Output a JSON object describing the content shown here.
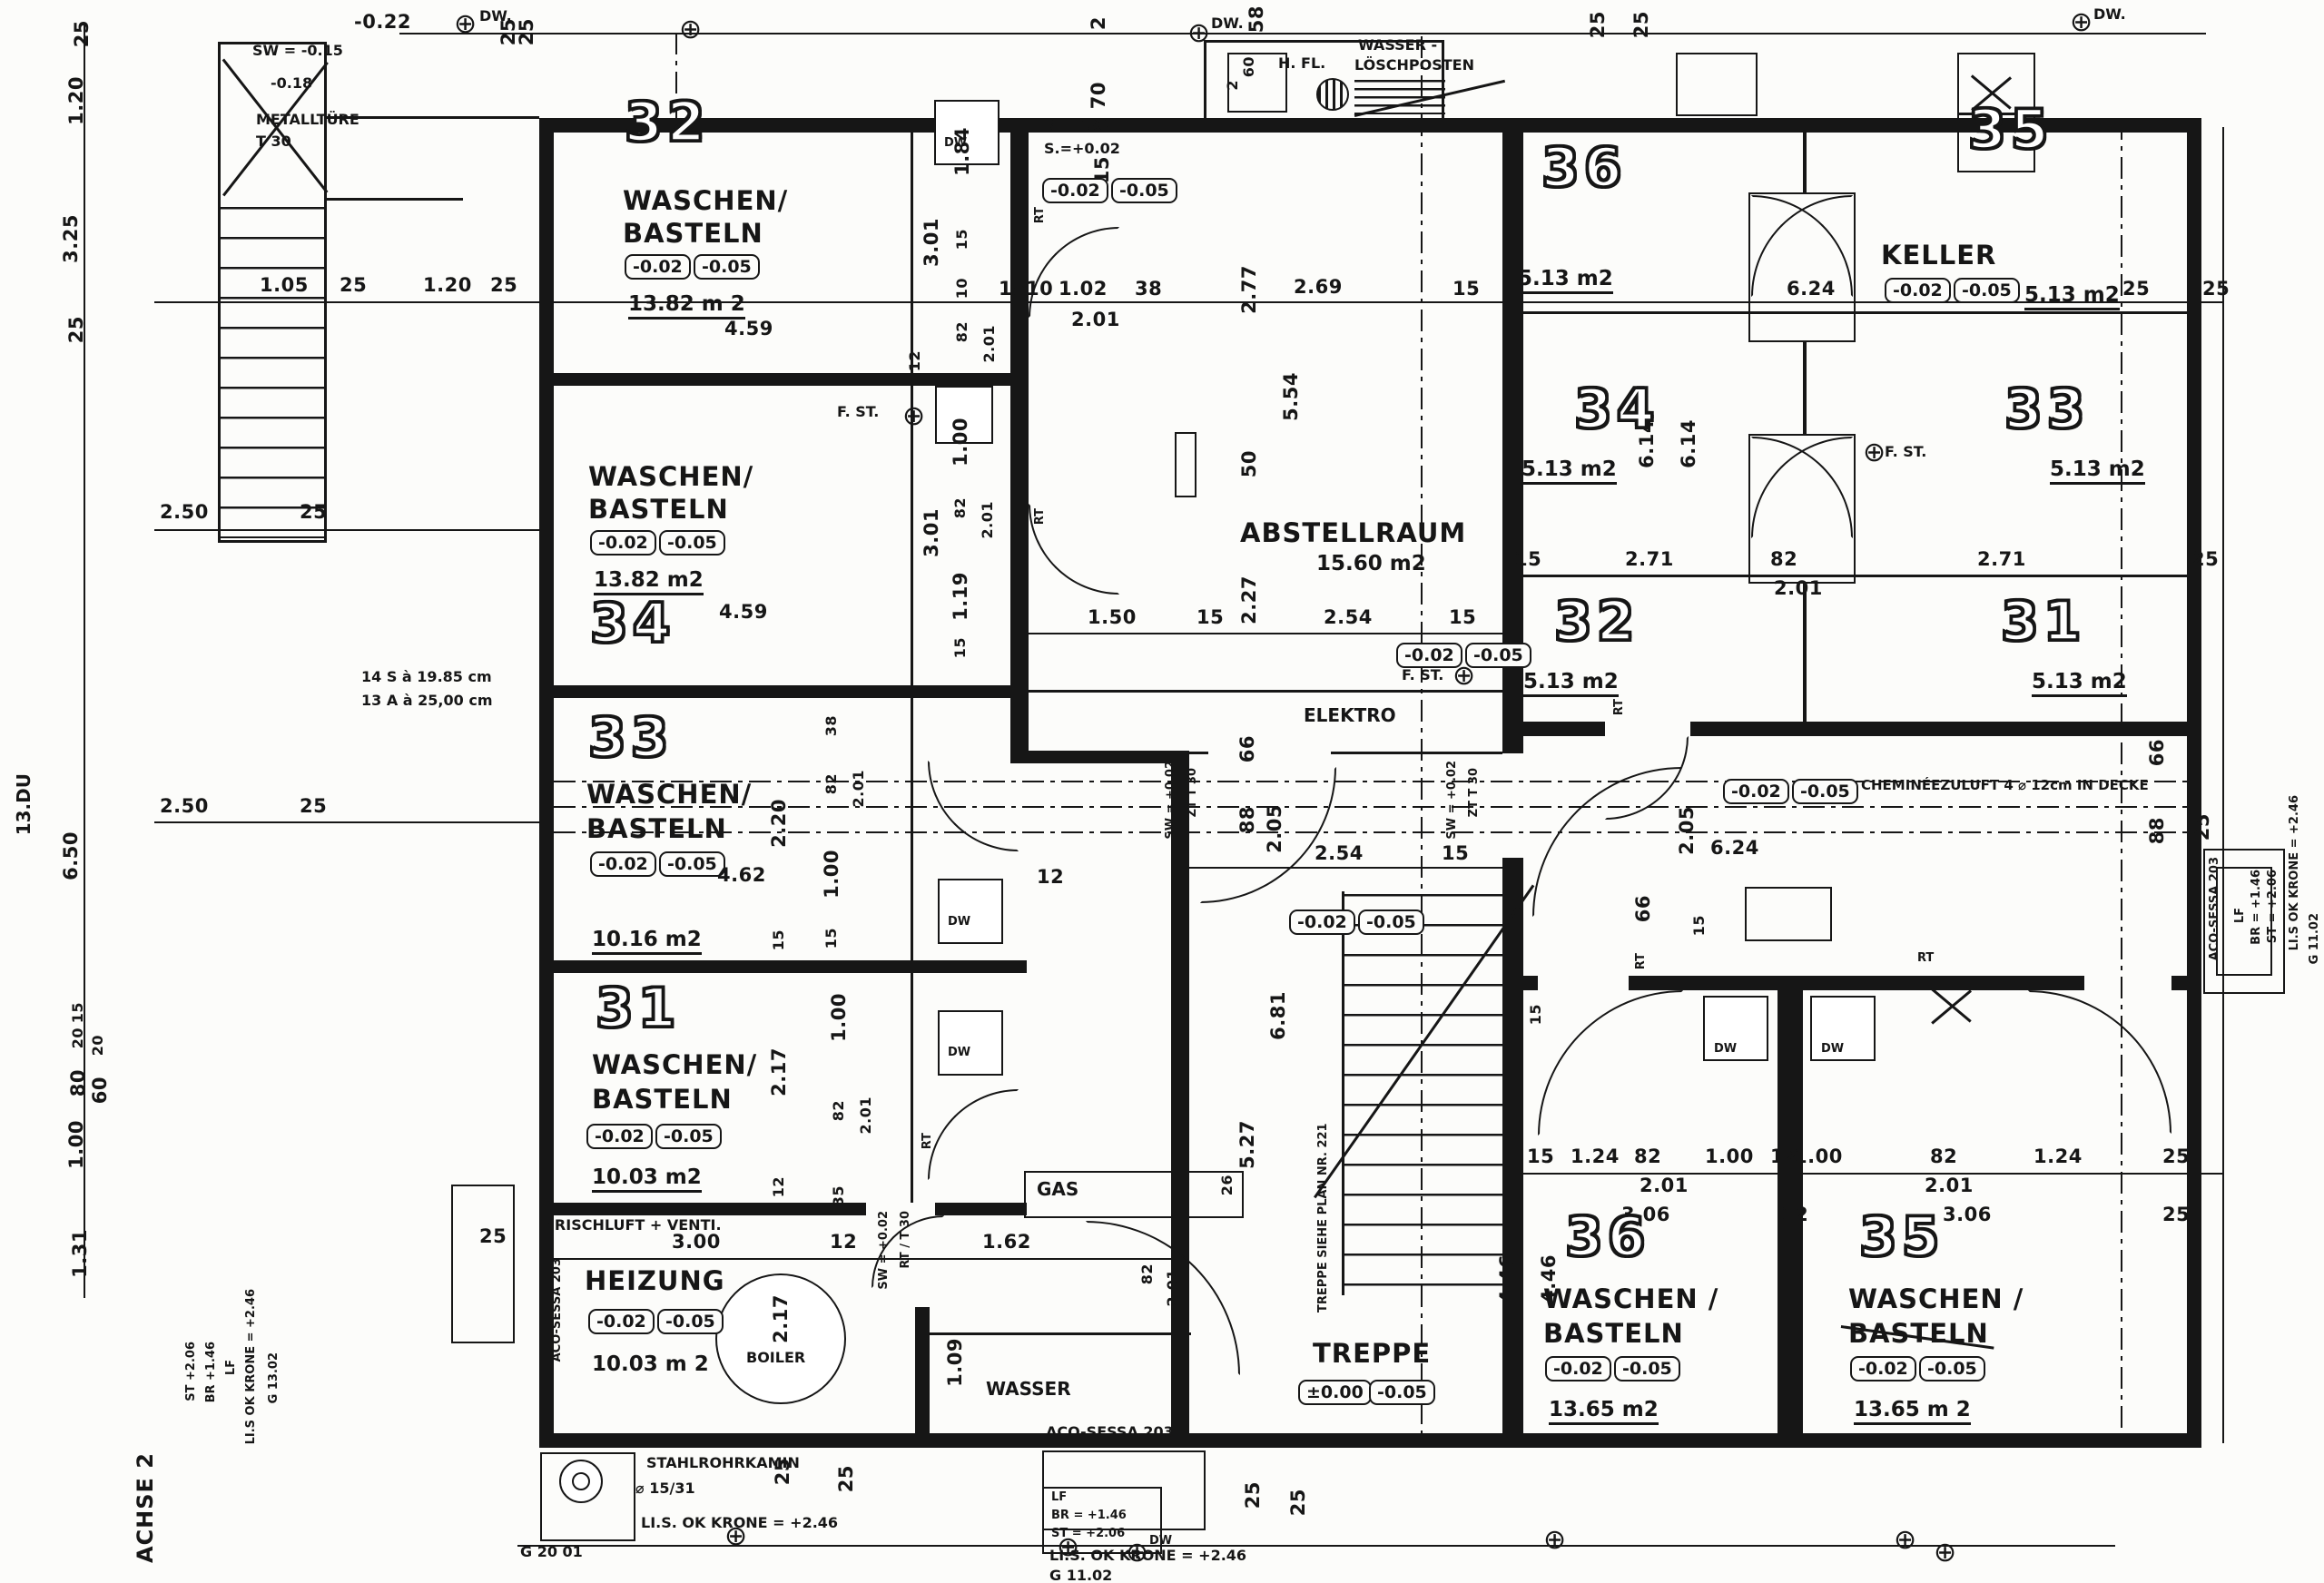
{
  "rooms": {
    "w32": {
      "num": "32",
      "l1": "WASCHEN/",
      "l2": "BASTELN",
      "area": "13.82 m 2"
    },
    "w34": {
      "num": "34",
      "l1": "WASCHEN/",
      "l2": "BASTELN",
      "area": "13.82 m2"
    },
    "w33": {
      "num": "33",
      "l1": "WASCHEN/",
      "l2": "BASTELN",
      "area": "10.16 m2"
    },
    "w31": {
      "num": "31",
      "l1": "WASCHEN/",
      "l2": "BASTELN",
      "area": "10.03 m2"
    },
    "heizung": {
      "name": "HEIZUNG",
      "area": "10.03 m 2"
    },
    "k36": {
      "num": "36",
      "area": "5.13 m2"
    },
    "k35": {
      "num": "35",
      "name": "KELLER",
      "area": "5.13 m2"
    },
    "k34": {
      "num": "34",
      "area": "5.13 m2"
    },
    "k33": {
      "num": "33",
      "area": "5.13 m2"
    },
    "k32": {
      "num": "32",
      "area": "5.13 m2"
    },
    "k31": {
      "num": "31",
      "area": "5.13 m2"
    },
    "abst": {
      "name": "ABSTELLRAUM",
      "area": "15.60 m2"
    },
    "elektro": {
      "name": "ELEKTRO"
    },
    "treppe": {
      "name": "TREPPE"
    },
    "b36": {
      "num": "36",
      "l1": "WASCHEN /",
      "l2": "BASTELN",
      "area": "13.65 m2"
    },
    "b35": {
      "num": "35",
      "l1": "WASCHEN /",
      "l2": "BASTELN",
      "area": "13.65 m 2"
    },
    "wasser": {
      "name": "WASSER"
    },
    "gas": {
      "name": "GAS"
    },
    "boiler": {
      "name": "BOILER"
    }
  },
  "levels": {
    "m02": "-0.02",
    "m05": "-0.05",
    "p00": "±0.00"
  },
  "annotations": {
    "minus022": "-0.22",
    "sw015": "SW = -0.15",
    "minus018": "-0.18",
    "metalltuere": "METALLTÜRE",
    "t30": "T 30",
    "dw": "DW.",
    "dw2": "DW",
    "rt_t30": "RT.  T 30",
    "s002": "S.=+0.02",
    "hfl": "H. FL.",
    "wasser1": "WASSER -",
    "wasser2": "LÖSCHPOSTEN",
    "fst": "F. ST.",
    "rt": "RT",
    "cheminee": "CHEMINÉEZULUFT  4 ⌀ 12cm IN DECKE",
    "sw_plus": "SW = +0.02",
    "zt_t30": "ZT  T 30",
    "rt_t30b": "RT / T 30",
    "frischluft": "FRISCHLUFT + VENTI.",
    "stahlrohrkamin": "STAHLROHRKAMIN",
    "kamin_d": "⌀ 15/31",
    "krone": "LI.S. OK KRONE = +2.46",
    "krone2": "LI.S OK KRONE = +2.46",
    "g2001": "G  20 01",
    "g1102": "G 11.02",
    "g1302": "G  13.02",
    "aco": "ACO-SESSA 203",
    "lf": "LF",
    "br146": "BR = +1.46",
    "st206": "ST = +2.06",
    "st_l": "ST  +2.06",
    "br_l": "BR  +1.46",
    "achse": "ACHSE 2",
    "du13": "13.DU",
    "note1": "14 S à 19.85 cm",
    "note2": "13 A à 25,00 cm",
    "treppe_plan": "TREPPE  SIEHE  PLAN  NR. 221"
  },
  "icons": {
    "benchmark": "⊕"
  },
  "dims": {
    "v2": "2",
    "v10": "10",
    "v12": "12",
    "v15": "15",
    "v20": "20",
    "v25": "25",
    "v26": "26",
    "v35": "35",
    "v38": "38",
    "v50": "50",
    "v58": "58",
    "v60": "60",
    "v66": "66",
    "v70": "70",
    "v80": "80",
    "v82": "82",
    "v88": "88",
    "v100": "1.00",
    "v102": "1.02",
    "v105": "1.05",
    "v109": "1.09",
    "v119": "1.19",
    "v120": "1.20",
    "v124": "1.24",
    "v131": "1.31",
    "v150": "1.50",
    "v162": "1.62",
    "v184": "1.84",
    "v201": "2.01",
    "v205": "2.05",
    "v217": "2.17",
    "v220": "2.20",
    "v227": "2.27",
    "v250": "2.50",
    "v254": "2.54",
    "v269": "2.69",
    "v271": "2.71",
    "v277": "2.77",
    "v300": "3.00",
    "v301": "3.01",
    "v306": "3.06",
    "v325": "3.25",
    "v446": "4.46",
    "v459": "4.59",
    "v462": "4.62",
    "v527": "5.27",
    "v554": "5.54",
    "v614": "6.14",
    "v624": "6.24",
    "v650": "6.50",
    "v681": "6.81"
  }
}
